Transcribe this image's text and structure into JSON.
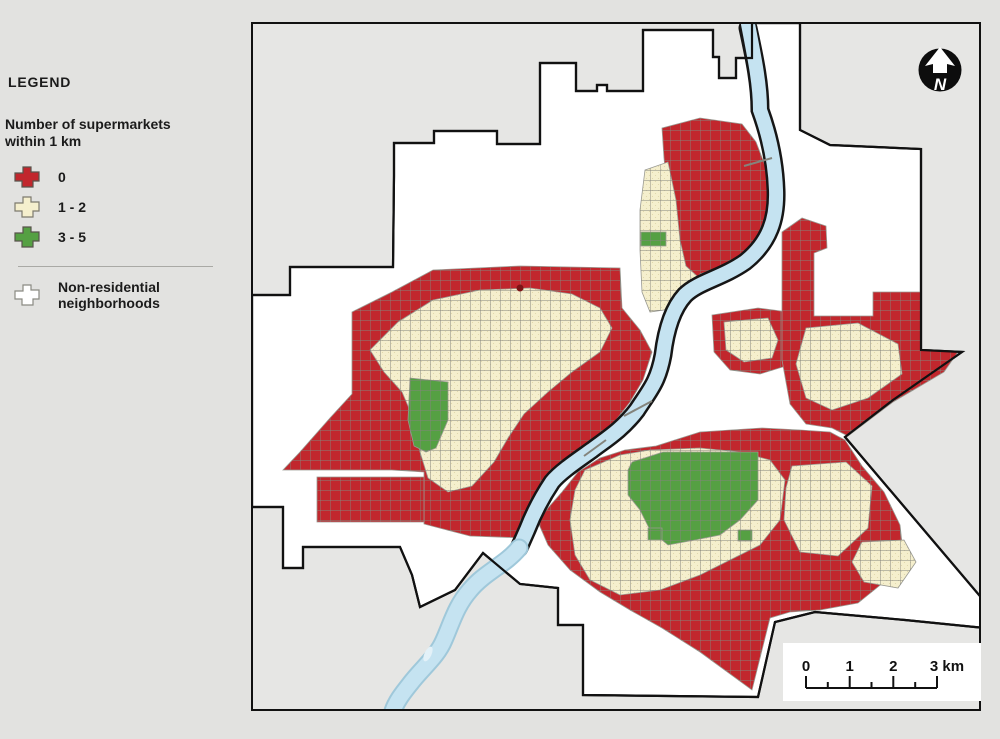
{
  "legend": {
    "title": "LEGEND",
    "subtitle_line1": "Number of supermarkets",
    "subtitle_line2": "within 1 km",
    "items": [
      {
        "label": "0",
        "color": "#c1272d"
      },
      {
        "label": "1 - 2",
        "color": "#f5efcd"
      },
      {
        "label": "3 - 5",
        "color": "#55a043"
      }
    ],
    "nonres": {
      "line1": "Non-residential",
      "line2": "neighborhoods",
      "color": "#ffffff"
    }
  },
  "map": {
    "north_label": "N",
    "scalebar": {
      "labels": [
        "0",
        "1",
        "2",
        "3 km"
      ]
    },
    "colors": {
      "zone_zero": "#c1272d",
      "zone_one_two": "#f5efcd",
      "zone_three_five": "#55a043",
      "river": "#c5e3f1",
      "non_residential": "#ffffff",
      "outside_city": "#e6e6e4",
      "street_lines": "#84847c",
      "boundary": "#111111"
    }
  }
}
